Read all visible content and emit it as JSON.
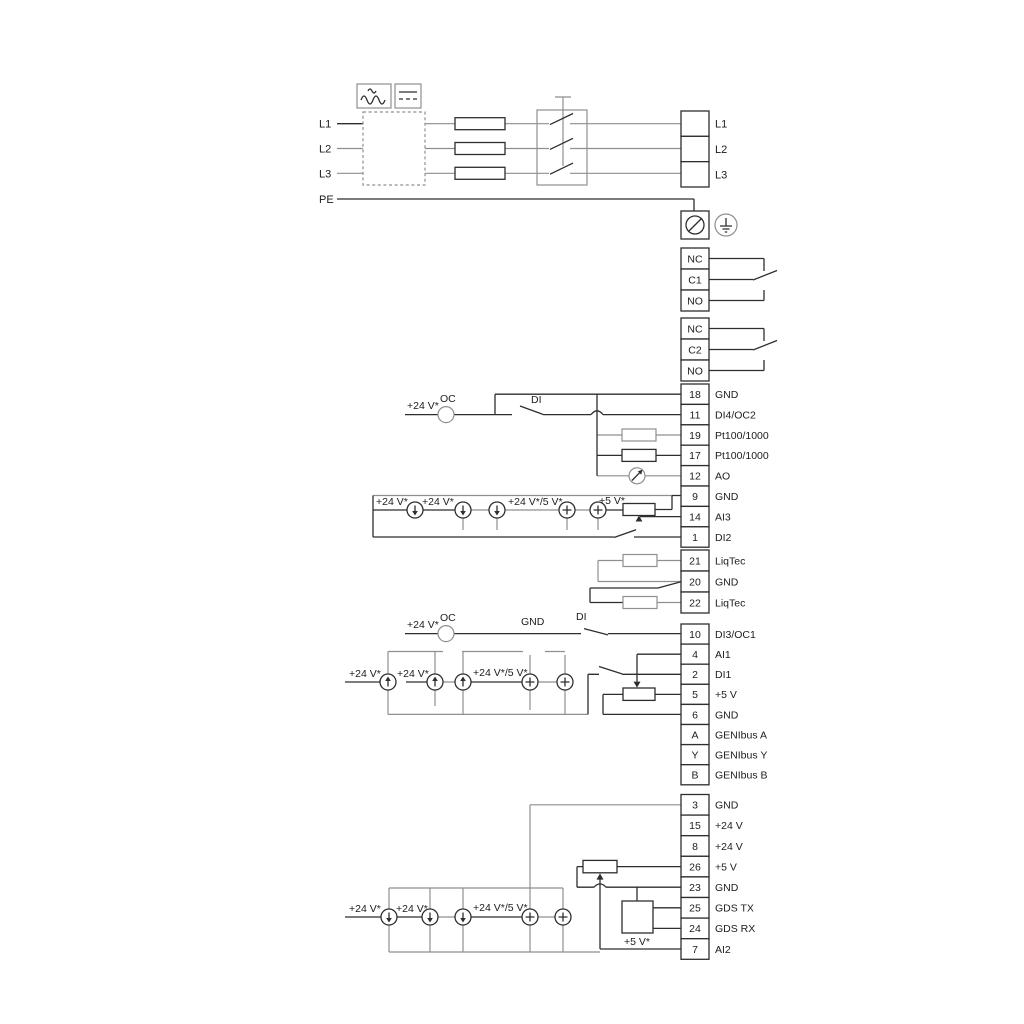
{
  "power": {
    "phase_inputs": [
      {
        "label": "L1"
      },
      {
        "label": "L2"
      },
      {
        "label": "L3"
      }
    ],
    "pe_label": "PE",
    "output_block": [
      {
        "label": "L1"
      },
      {
        "label": "L2"
      },
      {
        "label": "L3"
      }
    ],
    "icons": [
      "ac-wave-icon",
      "dc-link-icon",
      "rfi-filter-box",
      "fuse-icon",
      "contactor-icon",
      "screw-terminal-icon",
      "earth-ground-icon"
    ]
  },
  "relay_blocks": [
    {
      "rows": [
        {
          "label": "NC"
        },
        {
          "label": "C1"
        },
        {
          "label": "NO"
        }
      ]
    },
    {
      "rows": [
        {
          "label": "NC"
        },
        {
          "label": "C2"
        },
        {
          "label": "NO"
        }
      ]
    }
  ],
  "terminal_blocks": [
    {
      "id": "io-upper",
      "rows": [
        {
          "num": "18",
          "label": "GND"
        },
        {
          "num": "11",
          "label": "DI4/OC2"
        },
        {
          "num": "19",
          "label": "Pt100/1000"
        },
        {
          "num": "17",
          "label": "Pt100/1000"
        },
        {
          "num": "12",
          "label": "AO"
        },
        {
          "num": "9",
          "label": "GND"
        },
        {
          "num": "14",
          "label": "AI3"
        },
        {
          "num": "1",
          "label": "DI2"
        }
      ]
    },
    {
      "id": "liqtec",
      "rows": [
        {
          "num": "21",
          "label": "LiqTec"
        },
        {
          "num": "20",
          "label": "GND"
        },
        {
          "num": "22",
          "label": "LiqTec"
        }
      ]
    },
    {
      "id": "io-mid",
      "rows": [
        {
          "num": "10",
          "label": "DI3/OC1"
        },
        {
          "num": "4",
          "label": "AI1"
        },
        {
          "num": "2",
          "label": "DI1"
        },
        {
          "num": "5",
          "label": "+5 V"
        },
        {
          "num": "6",
          "label": "GND"
        },
        {
          "num": "A",
          "label": "GENIbus A"
        },
        {
          "num": "Y",
          "label": "GENIbus Y"
        },
        {
          "num": "B",
          "label": "GENIbus B"
        }
      ]
    },
    {
      "id": "io-lower",
      "rows": [
        {
          "num": "3",
          "label": "GND"
        },
        {
          "num": "15",
          "label": "+24 V"
        },
        {
          "num": "8",
          "label": "+24 V"
        },
        {
          "num": "26",
          "label": "+5 V"
        },
        {
          "num": "23",
          "label": "GND"
        },
        {
          "num": "25",
          "label": "GDS TX"
        },
        {
          "num": "24",
          "label": "GDS RX"
        },
        {
          "num": "7",
          "label": "AI2"
        }
      ]
    }
  ],
  "annotations": [
    {
      "name": "label-supply-24v",
      "text": "+24 V*"
    },
    {
      "name": "label-open-collector",
      "text": "OC"
    },
    {
      "name": "label-digital-input",
      "text": "DI"
    },
    {
      "name": "label-supply-24v",
      "text": "+24 V*"
    },
    {
      "name": "label-supply-24v",
      "text": "+24 V*"
    },
    {
      "name": "label-supply-24v-5v",
      "text": "+24 V*/5 V*"
    },
    {
      "name": "label-supply-5v",
      "text": "+5 V*"
    },
    {
      "name": "label-supply-24v",
      "text": "+24 V*"
    },
    {
      "name": "label-open-collector",
      "text": "OC"
    },
    {
      "name": "label-gnd",
      "text": "GND"
    },
    {
      "name": "label-digital-input",
      "text": "DI"
    },
    {
      "name": "label-supply-24v",
      "text": "+24 V*"
    },
    {
      "name": "label-supply-24v",
      "text": "+24 V*"
    },
    {
      "name": "label-supply-24v-5v",
      "text": "+24 V*/5 V*"
    },
    {
      "name": "label-supply-24v",
      "text": "+24 V*"
    },
    {
      "name": "label-supply-24v",
      "text": "+24 V*"
    },
    {
      "name": "label-supply-24v-5v",
      "text": "+24 V*/5 V*"
    },
    {
      "name": "label-supply-5v",
      "text": "+5 V*"
    }
  ],
  "symbol_icons": [
    "current-source-down-icon",
    "current-source-up-icon",
    "voltage-source-plus-icon",
    "resistor-icon",
    "potentiometer-icon",
    "analog-output-meter-icon",
    "relay-changeover-icon",
    "digital-input-switch-icon",
    "gds-sensor-box"
  ]
}
